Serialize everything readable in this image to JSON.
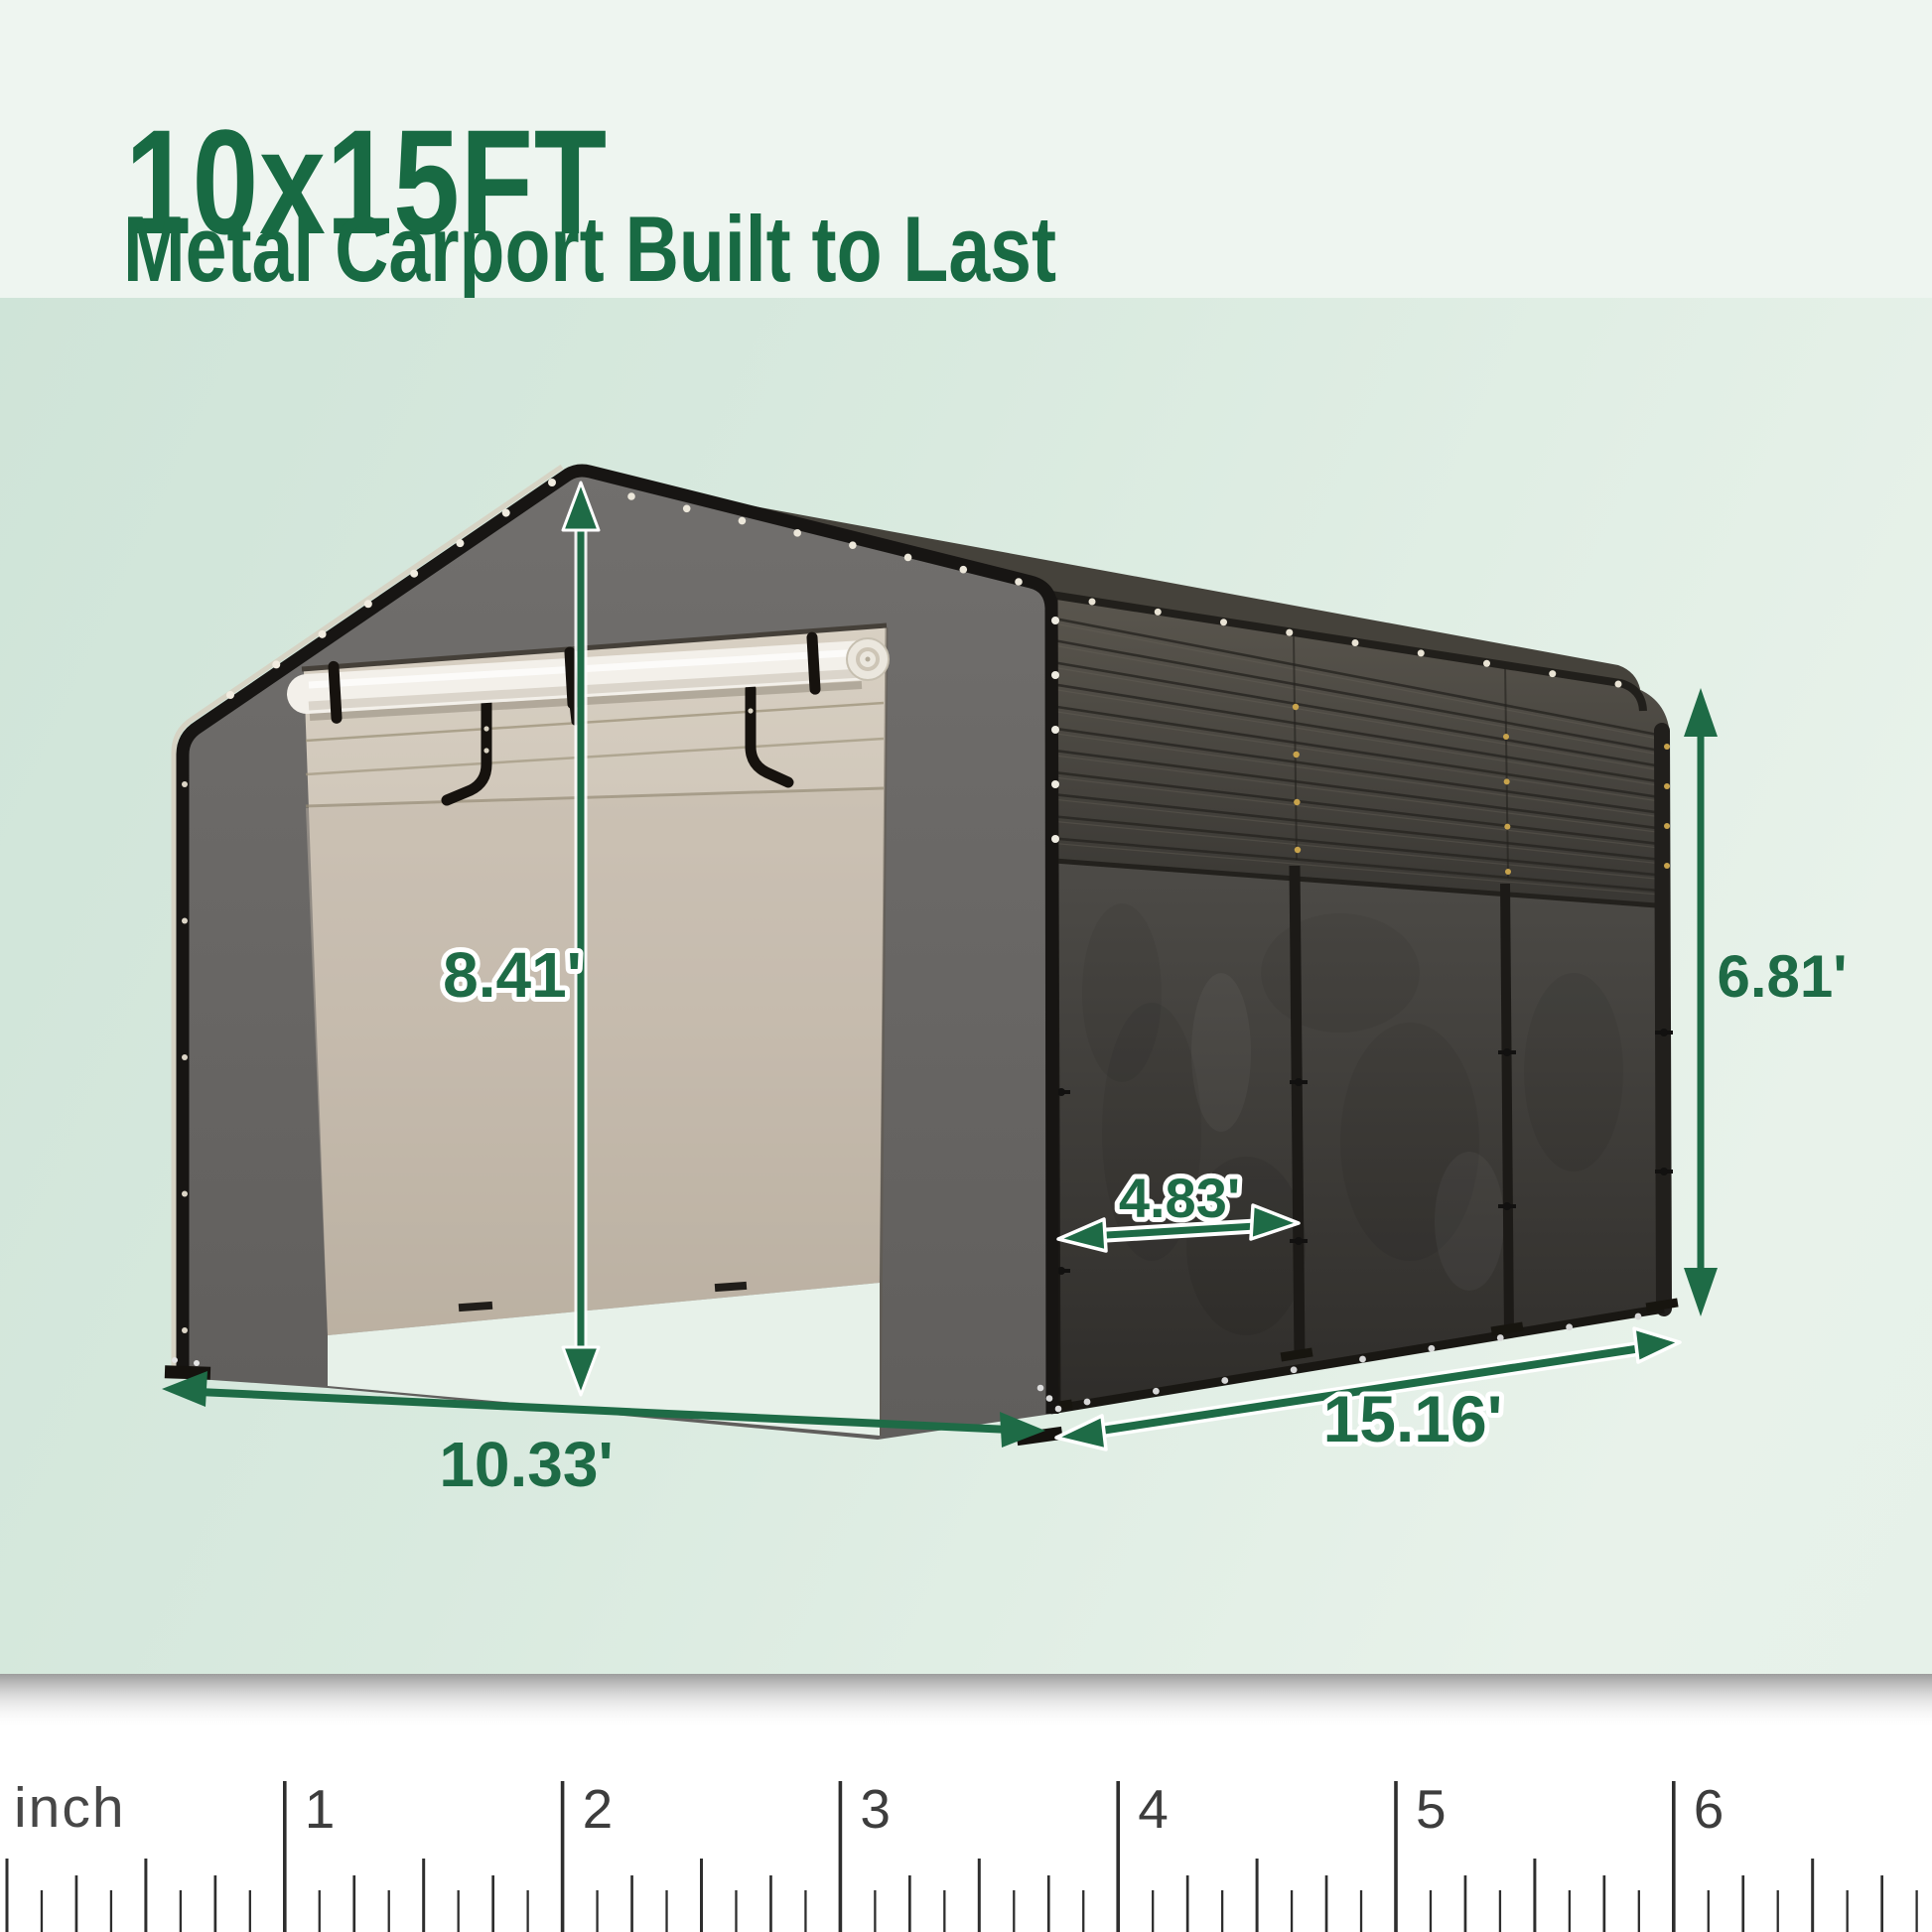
{
  "header": {
    "title": "10x15FT",
    "subtitle": "Metal Carport Built to Last"
  },
  "dimensions": {
    "front_height": {
      "label": "8.41'"
    },
    "side_height": {
      "label": "6.81'"
    },
    "panel_width": {
      "label": "4.83'"
    },
    "front_width": {
      "label": "10.33'"
    },
    "side_length": {
      "label": "15.16'"
    }
  },
  "ruler": {
    "unit_label": "inch",
    "major_marks": [
      "1",
      "2",
      "3",
      "4",
      "5",
      "6"
    ]
  },
  "colors": {
    "accent_green": "#1e6b46",
    "title_green": "#186a43",
    "header_bg": "#eef5f0",
    "scene_bg": "#d9eadf",
    "ruler_bg": "#ffffff",
    "carport_gray": "#696765",
    "tarp_dark": "#3c3a36",
    "interior_beige": "#c9bfb0",
    "roll_white": "#f3f0ea"
  }
}
